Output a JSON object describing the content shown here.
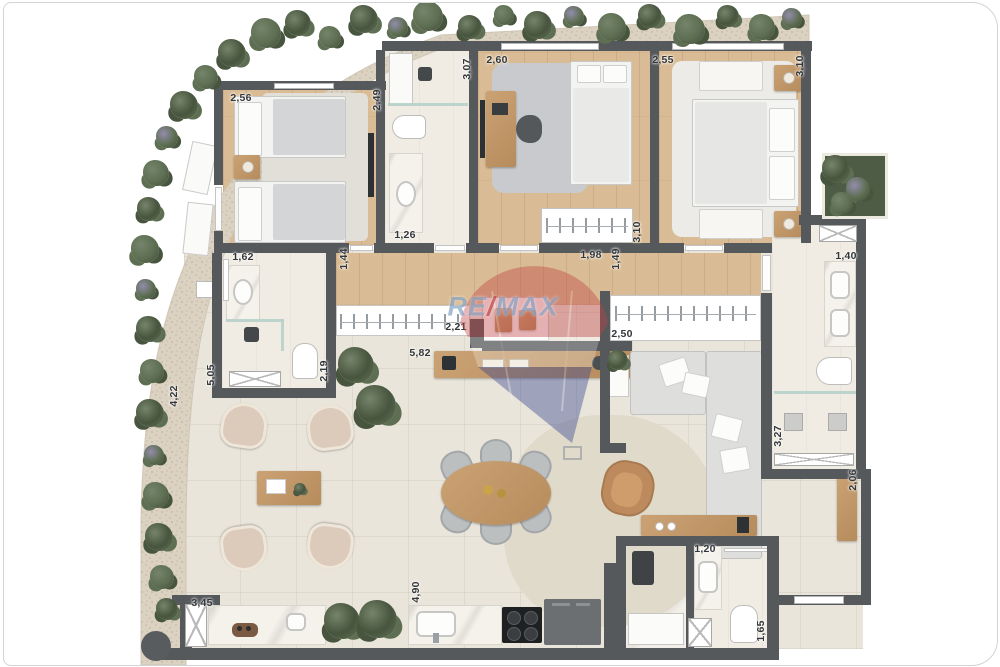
{
  "document": {
    "kind": "apartment-floor-plan"
  },
  "watermark": {
    "re": "RE",
    "slash": "/",
    "max": "MAX"
  },
  "palette": {
    "wall": "#56595c",
    "wood_floor": "#d9bc95",
    "tile_floor": "#e9e5da",
    "bath_floor": "#f0ece3",
    "gravel": "#dcd2c2",
    "furniture_wood": "#c09468",
    "shrub_dark": "#47543e",
    "shrub_mid": "#5d6e52",
    "shrub_light": "#75846a",
    "flower": "#938cab",
    "watermark_red": "#c24043",
    "watermark_blue": "#2f3f8e"
  },
  "dimension_labels": [
    {
      "value": "2,56",
      "x": 237,
      "y": 95,
      "vertical": false
    },
    {
      "value": "2,49",
      "x": 373,
      "y": 97,
      "vertical": true
    },
    {
      "value": "3,07",
      "x": 463,
      "y": 66,
      "vertical": true
    },
    {
      "value": "2,60",
      "x": 493,
      "y": 57,
      "vertical": false
    },
    {
      "value": "2,55",
      "x": 659,
      "y": 57,
      "vertical": false
    },
    {
      "value": "3,10",
      "x": 796,
      "y": 63,
      "vertical": true
    },
    {
      "value": "1,26",
      "x": 401,
      "y": 232,
      "vertical": false
    },
    {
      "value": "1,62",
      "x": 239,
      "y": 254,
      "vertical": false
    },
    {
      "value": "1,44",
      "x": 340,
      "y": 256,
      "vertical": true
    },
    {
      "value": "3,10",
      "x": 633,
      "y": 229,
      "vertical": true
    },
    {
      "value": "1,98",
      "x": 587,
      "y": 252,
      "vertical": false
    },
    {
      "value": "1,49",
      "x": 612,
      "y": 256,
      "vertical": true
    },
    {
      "value": "2,21",
      "x": 452,
      "y": 324,
      "vertical": false
    },
    {
      "value": "5,82",
      "x": 416,
      "y": 350,
      "vertical": false
    },
    {
      "value": "2,50",
      "x": 618,
      "y": 331,
      "vertical": false
    },
    {
      "value": "2,19",
      "x": 320,
      "y": 368,
      "vertical": true
    },
    {
      "value": "5,05",
      "x": 207,
      "y": 372,
      "vertical": true
    },
    {
      "value": "4,22",
      "x": 170,
      "y": 393,
      "vertical": true
    },
    {
      "value": "1,40",
      "x": 842,
      "y": 253,
      "vertical": false
    },
    {
      "value": "3,27",
      "x": 774,
      "y": 433,
      "vertical": true
    },
    {
      "value": "2,06",
      "x": 849,
      "y": 477,
      "vertical": true
    },
    {
      "value": "1,20",
      "x": 701,
      "y": 546,
      "vertical": false
    },
    {
      "value": "1,65",
      "x": 757,
      "y": 628,
      "vertical": true
    },
    {
      "value": "3,45",
      "x": 198,
      "y": 600,
      "vertical": false
    },
    {
      "value": "4,90",
      "x": 412,
      "y": 589,
      "vertical": true
    }
  ],
  "garden": {
    "clusters": [
      [
        262,
        30,
        30,
        "m"
      ],
      [
        294,
        20,
        26,
        "d"
      ],
      [
        326,
        34,
        22,
        "m"
      ],
      [
        360,
        16,
        28,
        "d"
      ],
      [
        394,
        24,
        20,
        "f"
      ],
      [
        424,
        13,
        30,
        "m"
      ],
      [
        466,
        24,
        24,
        "d"
      ],
      [
        500,
        12,
        20,
        "m"
      ],
      [
        534,
        22,
        28,
        "d"
      ],
      [
        570,
        13,
        20,
        "f"
      ],
      [
        608,
        24,
        28,
        "m"
      ],
      [
        646,
        13,
        24,
        "d"
      ],
      [
        686,
        26,
        30,
        "m"
      ],
      [
        724,
        13,
        22,
        "d"
      ],
      [
        758,
        24,
        26,
        "m"
      ],
      [
        788,
        15,
        20,
        "f"
      ],
      [
        228,
        50,
        28,
        "d"
      ],
      [
        202,
        74,
        24,
        "m"
      ],
      [
        180,
        102,
        28,
        "d"
      ],
      [
        163,
        134,
        22,
        "f"
      ],
      [
        152,
        170,
        26,
        "m"
      ],
      [
        145,
        206,
        24,
        "d"
      ],
      [
        141,
        246,
        28,
        "m"
      ],
      [
        142,
        286,
        20,
        "f"
      ],
      [
        145,
        326,
        26,
        "d"
      ],
      [
        148,
        368,
        24,
        "m"
      ],
      [
        146,
        410,
        28,
        "d"
      ],
      [
        150,
        452,
        20,
        "f"
      ],
      [
        152,
        492,
        26,
        "m"
      ],
      [
        155,
        534,
        28,
        "d"
      ],
      [
        158,
        574,
        24,
        "m"
      ],
      [
        163,
        606,
        22,
        "d"
      ],
      [
        832,
        166,
        28,
        "d"
      ],
      [
        854,
        186,
        24,
        "f"
      ],
      [
        838,
        200,
        22,
        "m"
      ]
    ]
  },
  "indoor_plants": [
    [
      352,
      362,
      36
    ],
    [
      372,
      402,
      40
    ],
    [
      338,
      618,
      36
    ],
    [
      374,
      616,
      38
    ],
    [
      614,
      357,
      20
    ],
    [
      296,
      486,
      12
    ]
  ]
}
